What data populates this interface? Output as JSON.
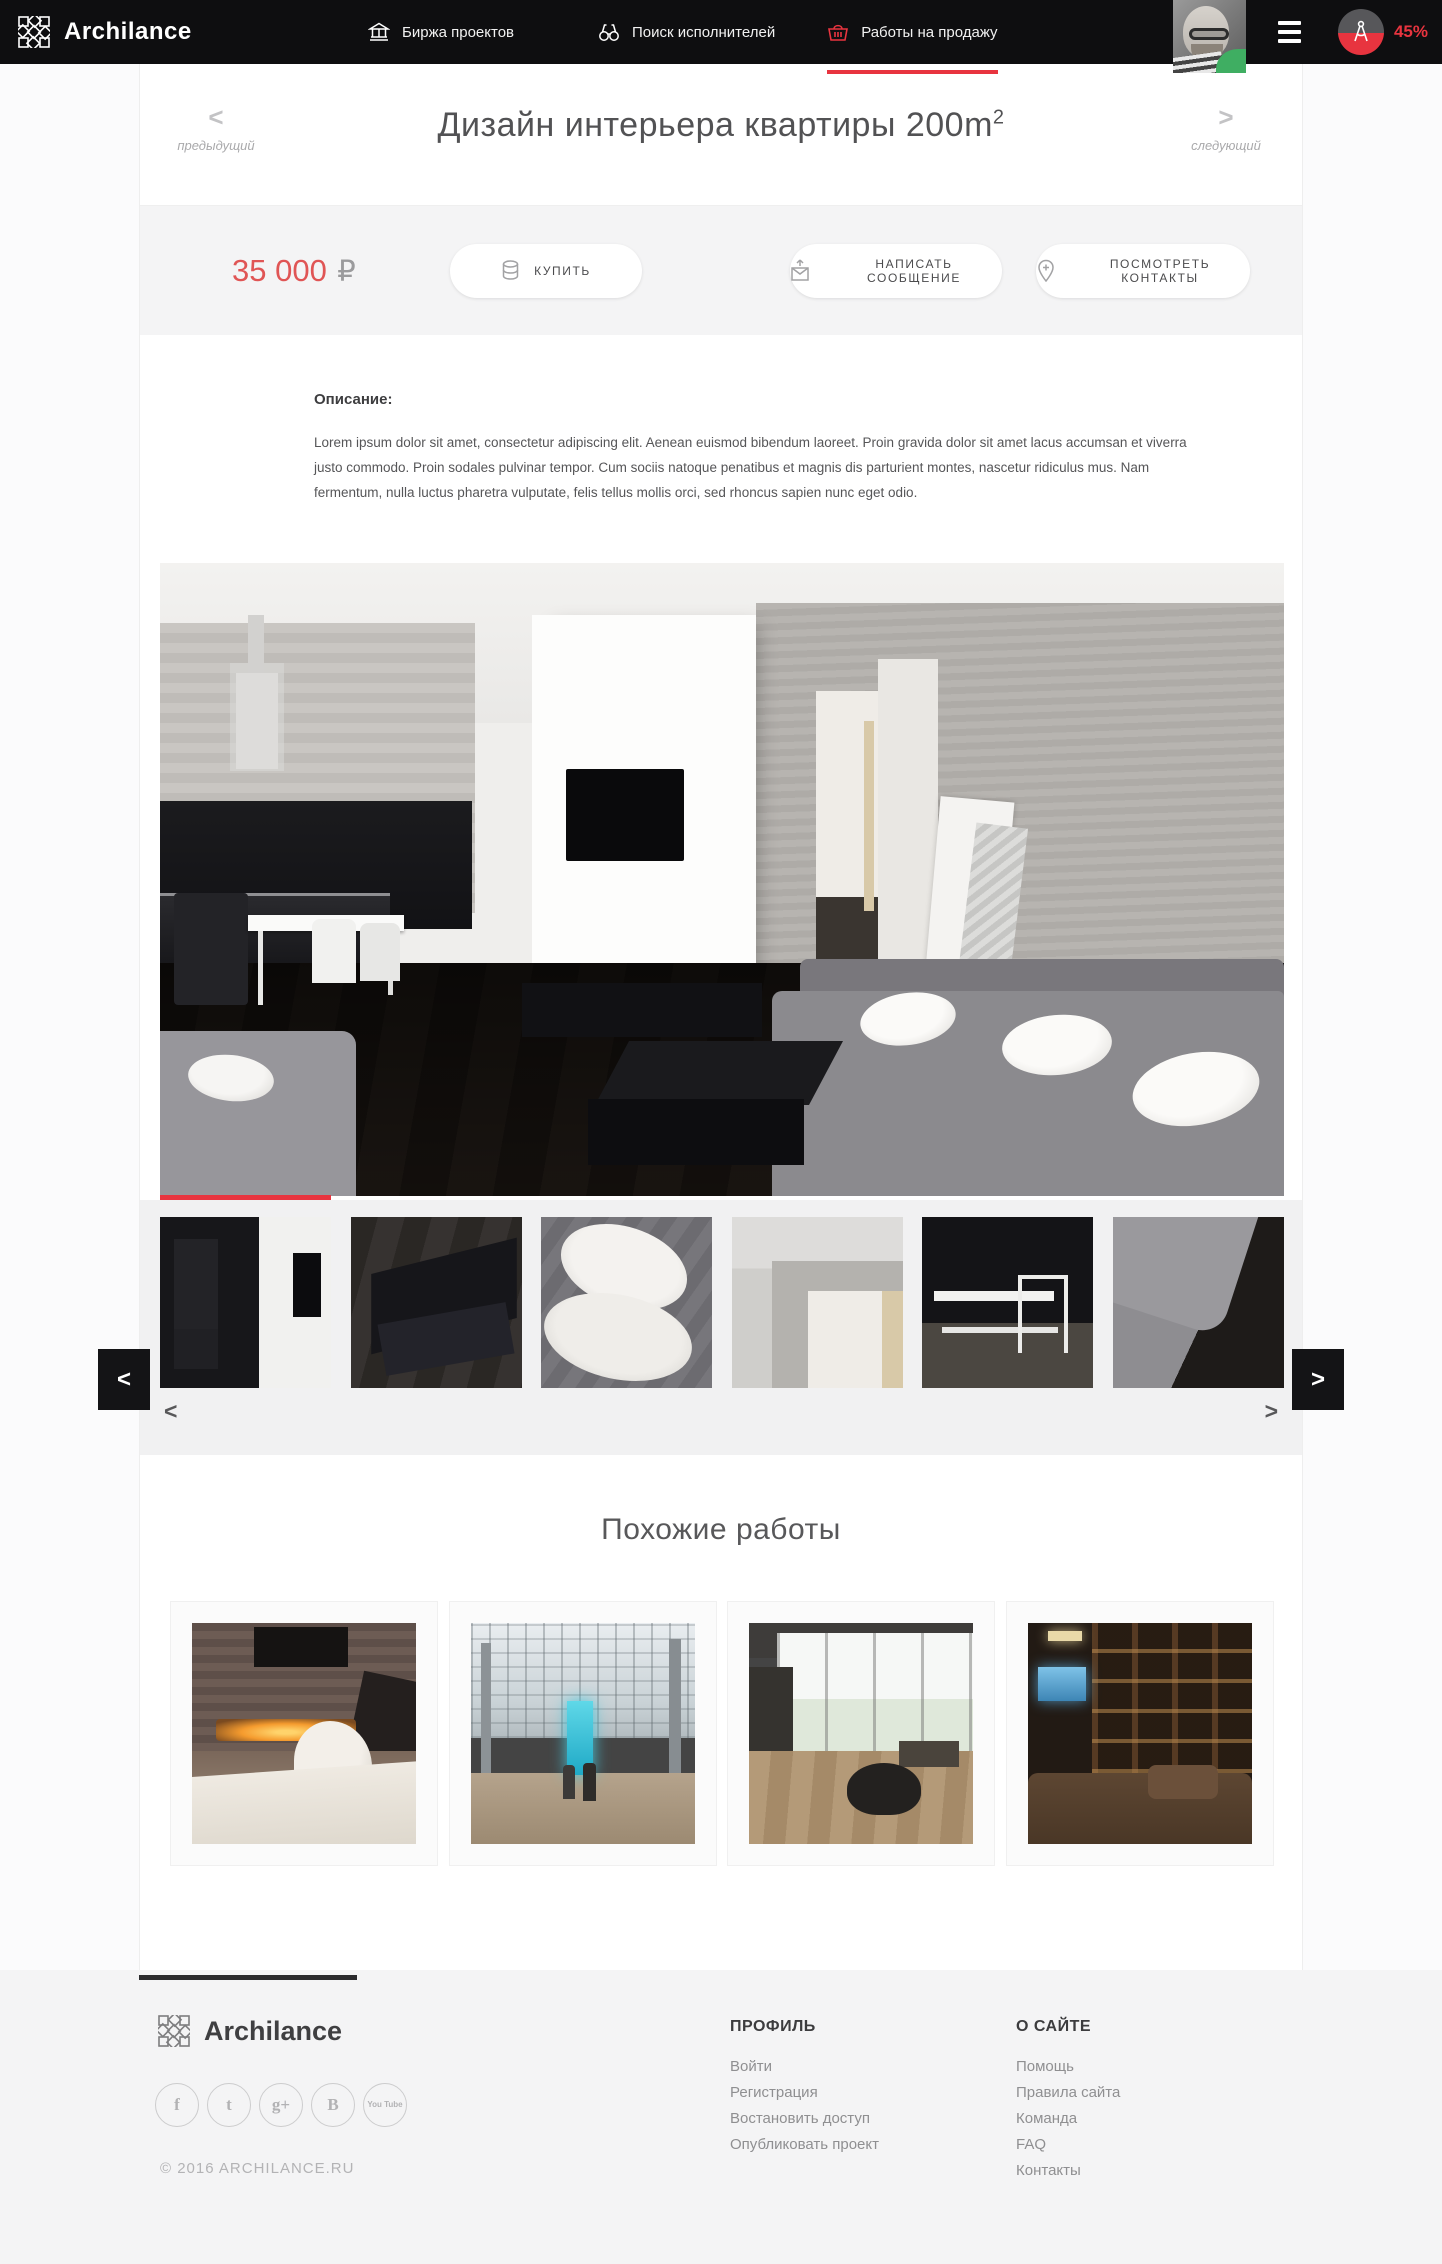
{
  "nav": {
    "brand": "Archilance",
    "items": [
      {
        "label": "Биржа проектов",
        "icon": "bank-icon"
      },
      {
        "label": "Поиск исполнителей",
        "icon": "binoculars-icon"
      },
      {
        "label": "Работы на продажу",
        "icon": "basket-icon",
        "active": true
      }
    ],
    "progress": "45%"
  },
  "pager": {
    "prev_arrow": "<",
    "prev_label": "предыдущий",
    "next_arrow": ">",
    "next_label": "следующий"
  },
  "page": {
    "title": "Дизайн интерьера квартиры 200m",
    "title_sup": "2"
  },
  "price": {
    "amount": "35 000",
    "currency": "₽"
  },
  "actions": {
    "buy": "КУПИТЬ",
    "message": "НАПИСАТЬ СООБЩЕНИЕ",
    "contacts": "ПОСМОТРЕТЬ КОНТАКТЫ"
  },
  "description": {
    "heading": "Описание:",
    "body": "Lorem ipsum dolor sit amet, consectetur adipiscing elit. Aenean euismod bibendum laoreet. Proin gravida dolor sit amet lacus accumsan et viverra justo commodo. Proin sodales pulvinar tempor. Cum sociis natoque penatibus et magnis dis parturient montes, nascetur ridiculus mus. Nam fermentum, nulla luctus pharetra vulputate, felis tellus mollis orci, sed rhoncus sapien nunc eget odio."
  },
  "gallery": {
    "prev_arrow": "<",
    "next_arrow": ">",
    "thumb_prev": "<",
    "thumb_next": ">"
  },
  "similar": {
    "heading": "Похожие работы"
  },
  "footer": {
    "brand": "Archilance",
    "copyright": "© 2016 ARCHILANCE.RU",
    "socials": [
      {
        "name": "facebook",
        "glyph": "f"
      },
      {
        "name": "twitter",
        "glyph": "t"
      },
      {
        "name": "google-plus",
        "glyph": "g+"
      },
      {
        "name": "vk",
        "glyph": "B"
      },
      {
        "name": "youtube",
        "glyph": "You Tube"
      }
    ],
    "columns": [
      {
        "title": "ПРОФИЛЬ",
        "links": [
          "Войти",
          "Регистрация",
          "Востановить доступ",
          "Опубликовать проект"
        ]
      },
      {
        "title": "О САЙТЕ",
        "links": [
          "Помощь",
          "Правила сайта",
          "Команда",
          "FAQ",
          "Контакты"
        ]
      }
    ]
  },
  "colors": {
    "accent": "#e8343f",
    "price_red": "#e05555",
    "navbar": "#0e0e10"
  }
}
